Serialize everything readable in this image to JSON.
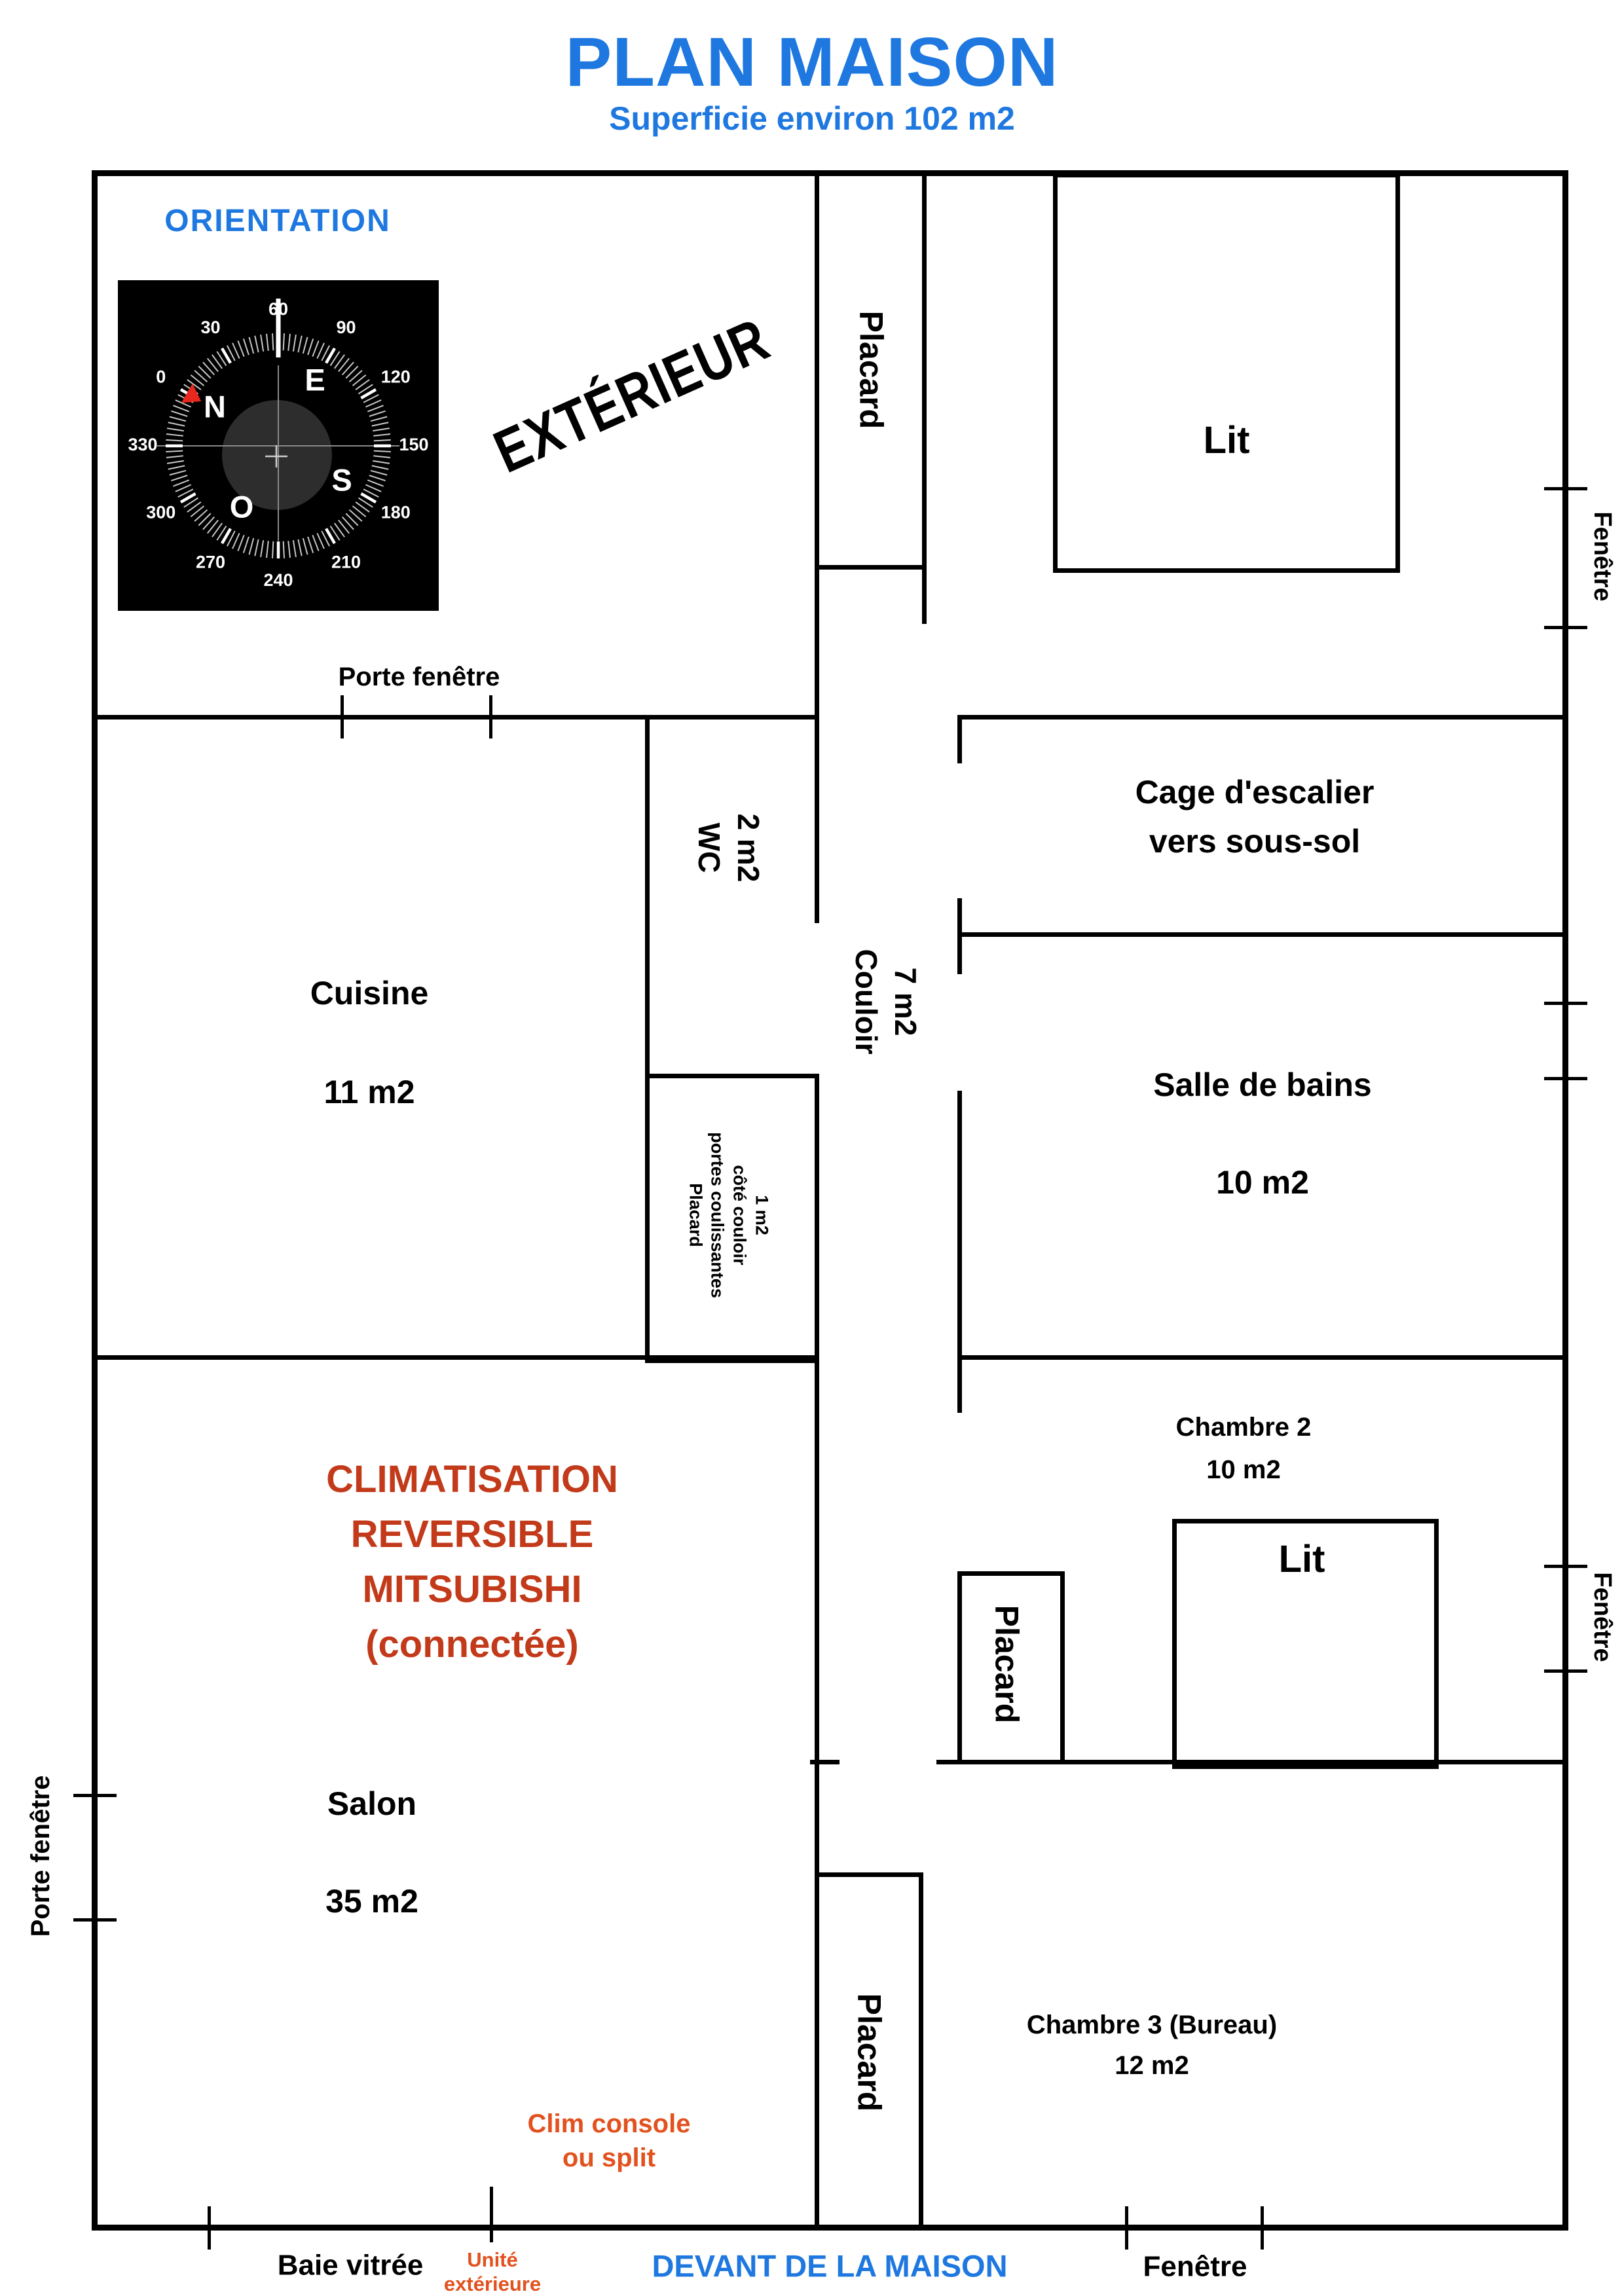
{
  "title": {
    "main": "PLAN MAISON",
    "subtitle": "Superficie environ 102 m2"
  },
  "colors": {
    "blue": "#1E78E0",
    "red": "#C23A1A",
    "orange": "#E2511E",
    "wall": "#000000",
    "compass_bg": "#000000",
    "compass_marker_red": "#E8281E"
  },
  "orientation": {
    "label": "ORIENTATION",
    "compass": {
      "numbers": [
        "0",
        "30",
        "60",
        "90",
        "120",
        "150",
        "180",
        "210",
        "240",
        "270",
        "300",
        "330"
      ],
      "cardinals": [
        "N",
        "E",
        "S",
        "O"
      ],
      "dial_rotation_deg": -60
    }
  },
  "exterior": {
    "label": "EXTÉRIEUR"
  },
  "rooms": {
    "cuisine": {
      "name": "Cuisine",
      "area": "11 m2"
    },
    "wc": {
      "name": "WC",
      "area": "2 m2"
    },
    "couloir": {
      "name": "Couloir",
      "area": "7 m2"
    },
    "cage": {
      "line1": "Cage d'escalier",
      "line2": "vers sous-sol"
    },
    "salle_de_bains": {
      "name": "Salle de bains",
      "area": "10 m2"
    },
    "chambre2": {
      "name": "Chambre 2",
      "area": "10 m2"
    },
    "salon": {
      "name": "Salon",
      "area": "35 m2"
    },
    "chambre3": {
      "name": "Chambre 3 (Bureau)",
      "area": "12 m2"
    }
  },
  "furniture": {
    "lit1": "Lit",
    "lit2": "Lit",
    "placard_haut": "Placard",
    "placard_coulissant": [
      "Placard",
      "portes coulissantes",
      "côté couloir",
      "1 m2"
    ],
    "placard_chambre2": "Placard",
    "placard_chambre3": "Placard"
  },
  "openings": {
    "porte_fenetre_haut": "Porte fenêtre",
    "porte_fenetre_salon": "Porte fenêtre",
    "fenetre_chambre1": "Fenêtre",
    "fenetre_salle_de_bains": "Fenêtre",
    "fenetre_chambre2": "Fenêtre",
    "fenetre_chambre3": "Fenêtre",
    "baie_vitree": "Baie vitrée"
  },
  "clim": {
    "bloc": [
      "CLIMATISATION",
      "REVERSIBLE",
      "MITSUBISHI",
      "(connectée)"
    ],
    "console": [
      "Clim console",
      "ou split"
    ],
    "unite": [
      "Unité",
      "extérieure"
    ]
  },
  "footer": {
    "devant": "DEVANT DE LA MAISON"
  }
}
